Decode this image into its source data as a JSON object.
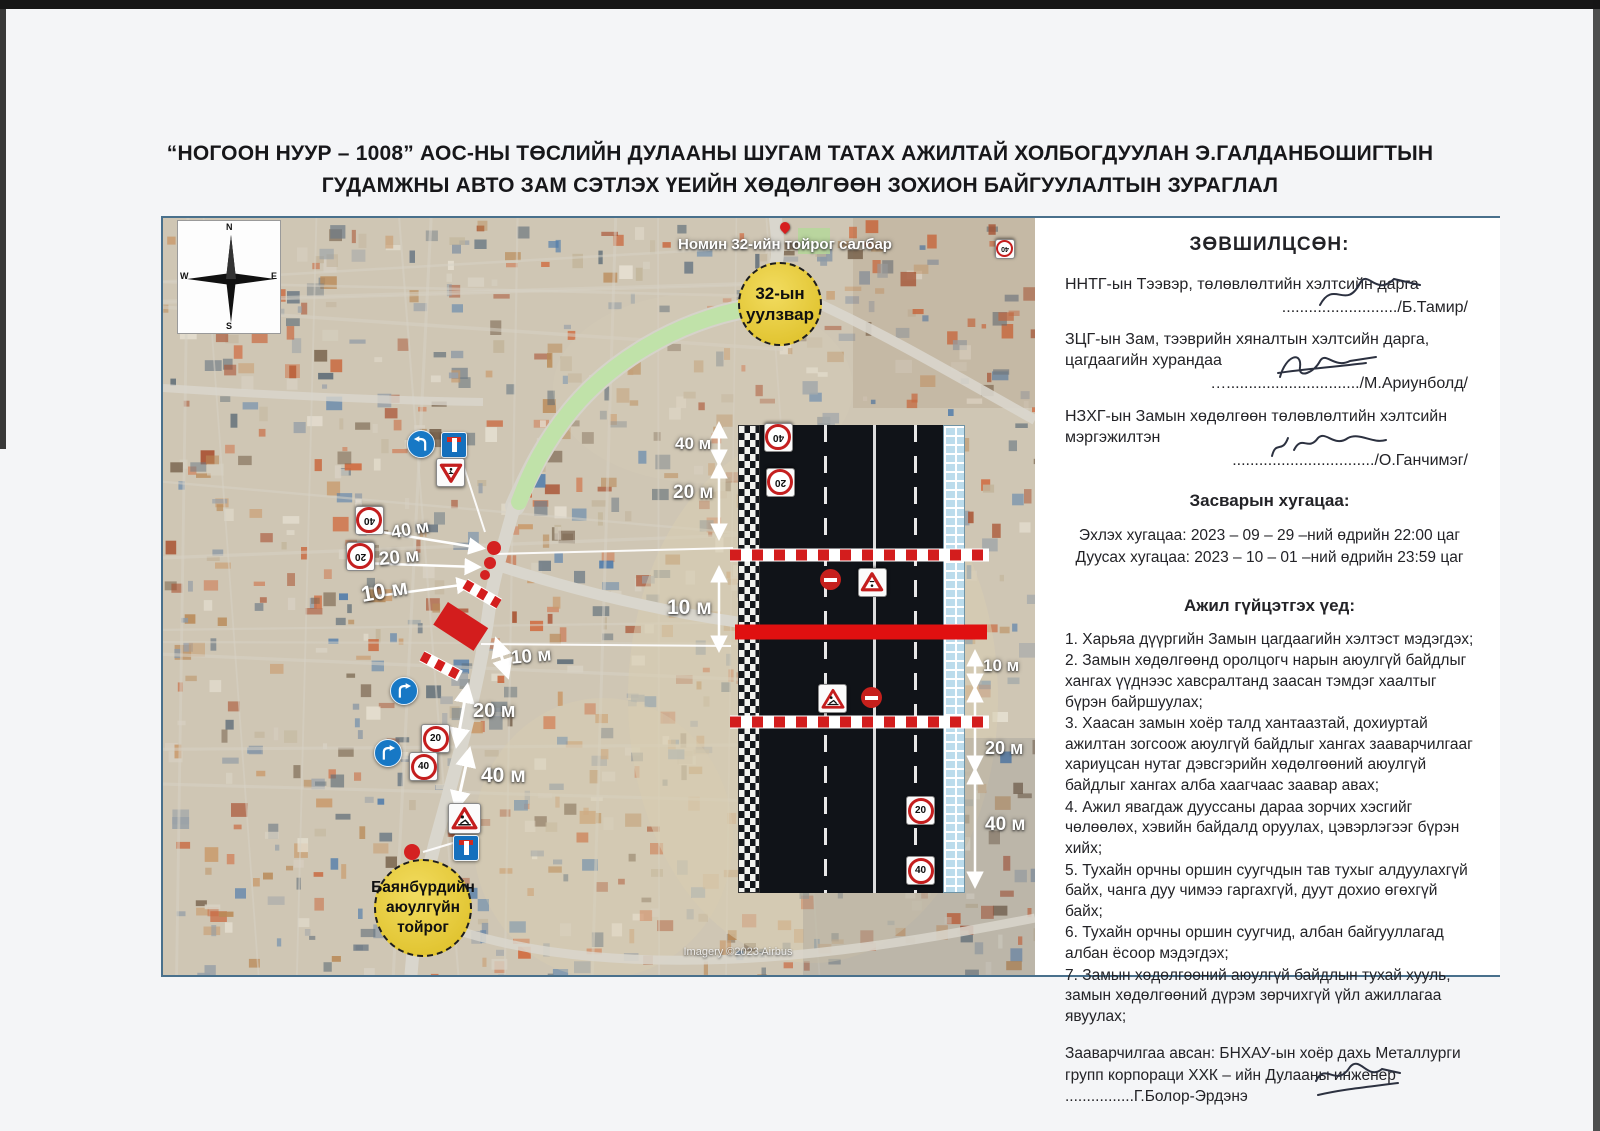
{
  "page": {
    "title_line1": "“НОГООН НУУР – 1008” АОС-НЫ ТӨСЛИЙН ДУЛААНЫ ШУГАМ ТАТАХ АЖИЛТАЙ ХОЛБОГДУУЛАН Э.ГАЛДАНБОШИГТЫН",
    "title_line2": "ГУДАМЖНЫ АВТО ЗАМ СЭТЛЭХ ҮЕИЙН ХӨДӨЛГӨӨН ЗОХИОН БАЙГУУЛАЛТЫН ЗУРАГЛАЛ"
  },
  "panel": {
    "approved_heading": "ЗӨВШИЛЦСӨН:",
    "approvals": [
      {
        "role": "ННТГ-ын Тээвэр, төлөвлөлтийн хэлтсийн дарга",
        "sign_line": "........................../Б.Тамир/"
      },
      {
        "role": "ЗЦГ-ын Зам, тээврийн хяналтын хэлтсийн дарга, цагдаагийн хурандаа",
        "sign_line": "…............................../М.Ариунболд/"
      },
      {
        "role": "НЗХГ-ын Замын хөдөлгөөн төлөвлөлтийн хэлтсийн мэргэжилтэн",
        "sign_line": "................................/О.Ганчимэг/"
      }
    ],
    "schedule_heading": "Засварын хугацаа:",
    "schedule_lines": [
      "Эхлэх хугацаа: 2023 – 09 – 29 –ний өдрийн 22:00 цаг",
      "Дуусах хугацаа: 2023 – 10 – 01 –ний өдрийн 23:59 цаг"
    ],
    "work_heading": "Ажил гүйцэтгэх үед:",
    "work_items": [
      "1. Харьяа дүүргийн Замын цагдаагийн хэлтэст мэдэгдэх;",
      "2. Замын хөдөлгөөнд оролцогч нарын аюулгүй байдлыг хангах үүднээс хавсралтанд заасан тэмдэг хаалтыг бүрэн байршуулах;",
      "3. Хаасан замын хоёр талд хантаазтай, дохиуртай ажилтан зогсоож аюулгүй байдлыг хангах зааварчилгааг хариуцсан нутаг дэвсгэрийн хөдөлгөөний аюулгүй байдлыг хангах алба хаагчаас заавар авах;",
      "4. Ажил явагдаж дууссаны дараа зорчих хэсгийг чөлөөлөх, хэвийн байдалд оруулах, цэвэрлэгээг бүрэн хийх;",
      "5. Тухайн орчны оршин суугчдын тав тухыг алдуулахгүй байх, чанга дуу чимээ гаргахгүй, дуут дохио өгөхгүй байх;",
      "6. Тухайн орчны оршин суугчид, албан байгууллагад албан ёсоор мэдэгдэх;",
      "7. Замын хөдөлгөөний аюулгүй байдлын тухай хууль, замын хөдөлгөөний дүрэм зөрчихгүй үйл ажиллагаа явуулах;"
    ],
    "instruction": "Зааварчилгаа авсан: БНХАУ-ын хоёр дахь Металлурги групп корпораци ХХК – ийн Дулааны инженер ................Г.Болор-Эрдэнэ"
  },
  "map": {
    "nomin_label": "Номин 32-ийн тойрог салбар",
    "junction_circle": {
      "line1": "32-ын",
      "line2": "уулзвар"
    },
    "roundabout_circle": {
      "line1": "Баянбүрдийн",
      "line2": "аюулгүйн",
      "line3": "тойрог"
    },
    "imagery_credit": "Imagery ©2023 Airbus",
    "compass": {
      "n": "N",
      "s": "S",
      "e": "E",
      "w": "W"
    },
    "measures": {
      "junction": [
        "40 м",
        "20 м",
        "10 м"
      ],
      "south": [
        "10 м",
        "20 м",
        "40 м"
      ],
      "diagram_left": [
        "40 м",
        "20 м",
        "10 м"
      ],
      "diagram_right": [
        "10 м",
        "20 м",
        "40 м"
      ]
    },
    "signs": {
      "speed20": "20",
      "speed40": "40"
    }
  },
  "colors": {
    "closure_red": "#d31d1d",
    "highlight_green": "#bfe3a6",
    "circle_yellow": "#e4c42c",
    "frame_blue": "#49708c"
  }
}
